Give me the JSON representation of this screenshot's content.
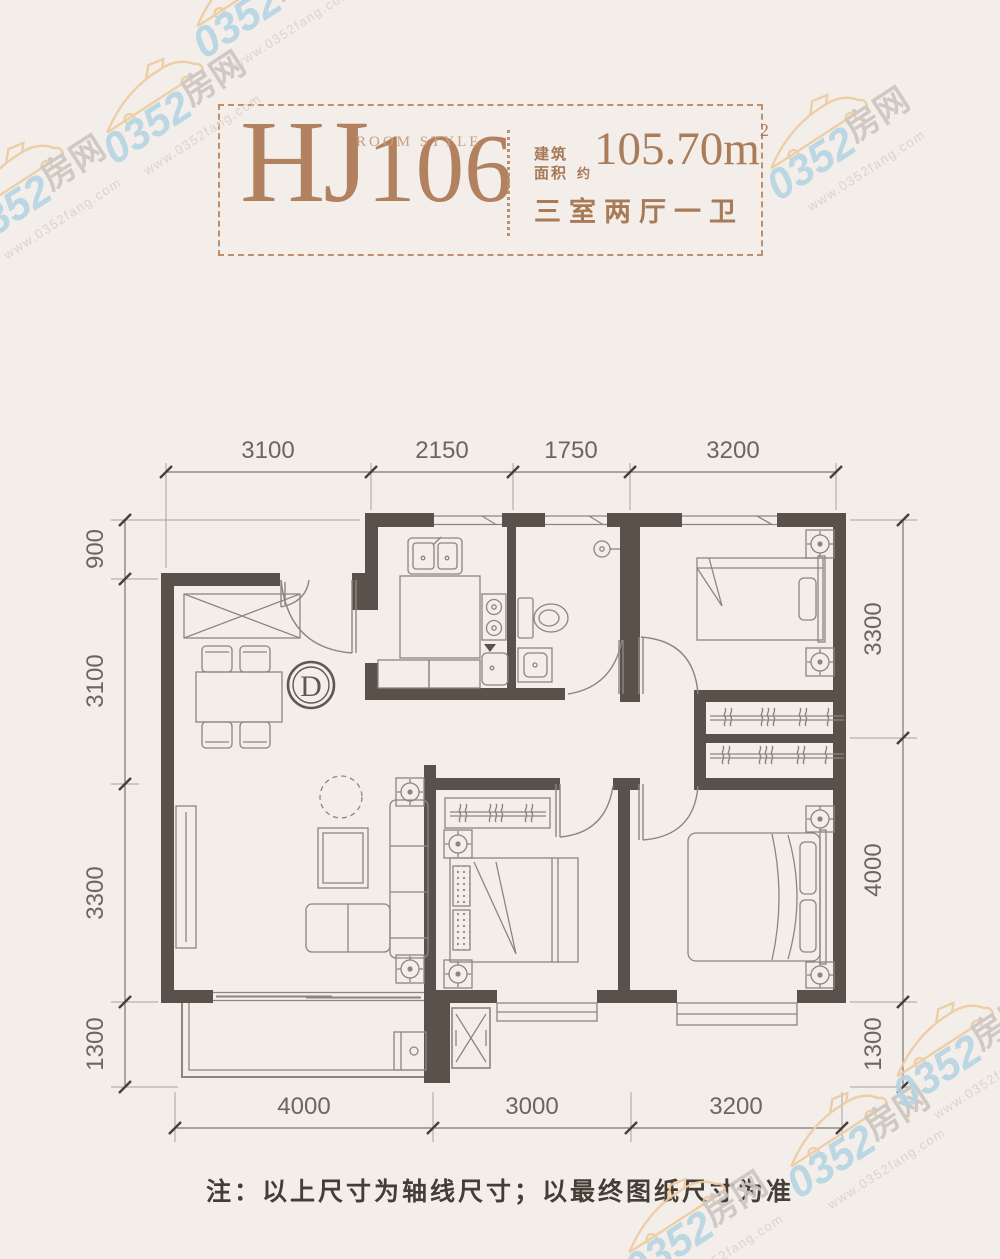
{
  "title": {
    "code_hj": "HJ",
    "code_num": "106",
    "room_style": "ROOM STYLE",
    "area_label_line1": "建筑",
    "area_label_line2": "面积",
    "area_approx": "约",
    "area_value": "105.70m",
    "area_exponent": "2",
    "layout_text": "三室两厅一卫"
  },
  "dimensions": {
    "top": [
      "3100",
      "2150",
      "1750",
      "3200"
    ],
    "left": [
      "900",
      "3100",
      "3300",
      "1300"
    ],
    "right": [
      "3300",
      "4000",
      "1300"
    ],
    "bottom": [
      "4000",
      "3000",
      "3200"
    ]
  },
  "plan": {
    "door_marker": "D"
  },
  "note": "注：以上尺寸为轴线尺寸；以最终图纸尺寸为准",
  "watermark": {
    "number": "0352",
    "suffix": "房网",
    "url": "www.0352fang.com"
  },
  "colors": {
    "background": "#f3eeea",
    "wall": "#5a514b",
    "accent_brown": "#b2815f",
    "dim_text": "#6b6661",
    "plan_line": "#8d867f",
    "note_text": "#443e37",
    "watermark_blue": "#b5d5e3",
    "watermark_orange": "#eecb9f",
    "watermark_gray": "#cdc5bf"
  }
}
